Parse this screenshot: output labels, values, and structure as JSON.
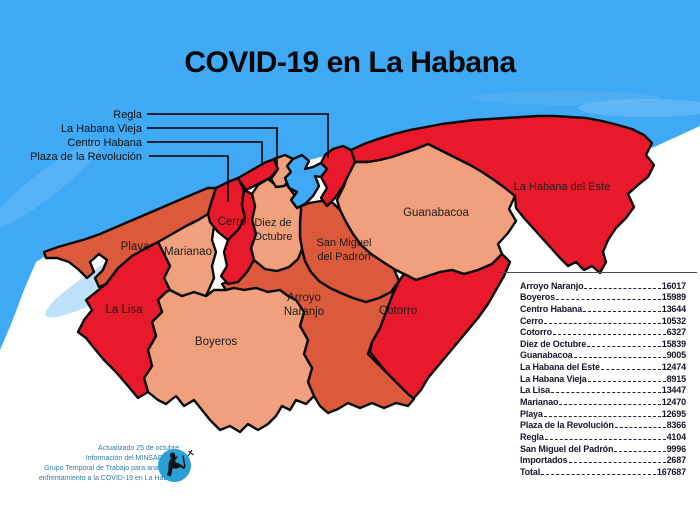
{
  "title": "COVID-19 en La Habana",
  "colors": {
    "sea": "#3fa9f5",
    "region_red": "#e8192b",
    "region_orange": "#db5a3b",
    "region_peach": "#f0a07c",
    "outline": "#0a0a0a",
    "footnote_text": "#2e7ca8",
    "logo_blue": "#2aa0d6"
  },
  "callouts": {
    "regla": "Regla",
    "habana_vieja": "La Habana Vieja",
    "centro_habana": "Centro Habana",
    "plaza": "Plaza de la Revolución"
  },
  "regions": {
    "playa": "Playa",
    "marianao": "Marianao",
    "la_lisa": "La Lisa",
    "boyeros": "Boyeros",
    "cerro": "Cerro",
    "diez1": "Diez de",
    "diez2": "Octubre",
    "arroyo1": "Arroyo",
    "arroyo2": "Naranjo",
    "smp1": "San Miguel",
    "smp2": "del Padrón",
    "guanabacoa": "Guanabacoa",
    "habana_del_este": "La Habana del Este",
    "cotorro": "Cotorro"
  },
  "table": {
    "rows": [
      {
        "name": "Arroyo Naranjo",
        "value": "16017"
      },
      {
        "name": "Boyeros",
        "value": "15989"
      },
      {
        "name": "Centro Habana",
        "value": "13644"
      },
      {
        "name": "Cerro",
        "value": "10532"
      },
      {
        "name": "Cotorro",
        "value": "6327"
      },
      {
        "name": "Diez de Octubre",
        "value": "15839"
      },
      {
        "name": "Guanabacoa",
        "value": "9005"
      },
      {
        "name": "La Habana del Este",
        "value": "12474"
      },
      {
        "name": "La Habana Vieja",
        "value": "8915"
      },
      {
        "name": "La Lisa",
        "value": "13447"
      },
      {
        "name": "Marianao",
        "value": "12470"
      },
      {
        "name": "Playa",
        "value": "12695"
      },
      {
        "name": "Plaza de la Revolución",
        "value": "8366"
      },
      {
        "name": "Regla",
        "value": "4104"
      },
      {
        "name": "San Miguel del Padrón",
        "value": "9996"
      },
      {
        "name": "Importados",
        "value": "2687"
      },
      {
        "name": "Total",
        "value": "167687"
      }
    ]
  },
  "footnote": {
    "lines": [
      "Actualizado 25 de octubre",
      "Información del MINSAP y del",
      "Grupo Temporal de Trabajo para analizar el",
      "enfrentamiento a la COVID-19 en La Habana"
    ]
  }
}
